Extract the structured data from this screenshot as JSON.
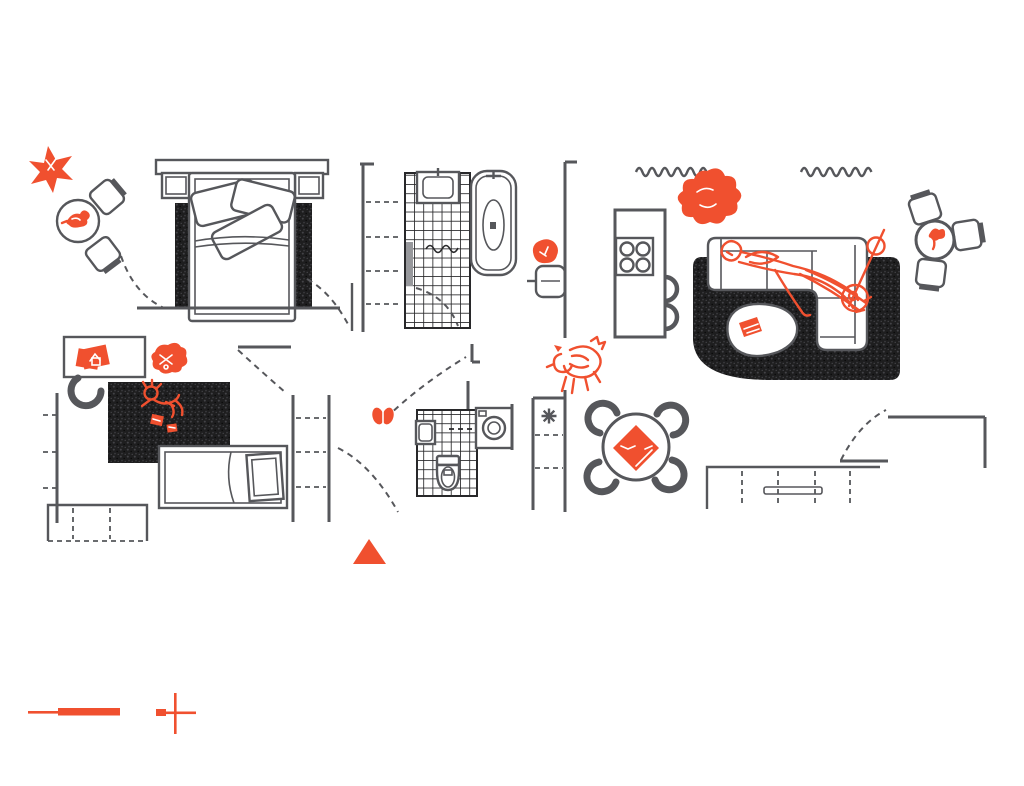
{
  "meta": {
    "kind": "hand-drawn apartment floor plan, top view, no text labels",
    "canvas": "1024x786"
  },
  "colors": {
    "paper": "#ffffff",
    "ink": "#56575b",
    "ink_dark": "#28282a",
    "accent": "#f0502f",
    "rug_dark": "#1e1e1f",
    "glass": "#97989c"
  },
  "rooms": [
    {
      "name": "balcony-left",
      "items": [
        "star-plant",
        "round-table",
        "bird",
        "chair",
        "chair"
      ]
    },
    {
      "name": "bedroom-primary",
      "items": [
        "headboard-shelf",
        "nightstand-left",
        "nightstand-right",
        "double-bed",
        "pillows-x3",
        "area-rug",
        "closet-shelves",
        "door-arcs"
      ]
    },
    {
      "name": "bathroom-main",
      "items": [
        "tiled-floor",
        "vanity-sink",
        "shower-screen",
        "shower-squiggle",
        "bathtub",
        "towel",
        "wall-cabinet"
      ]
    },
    {
      "name": "kitchen",
      "items": [
        "island-counter",
        "cooktop-4-burners",
        "bar-stool",
        "bar-stool",
        "curtain-wave-left",
        "curtain-wave-right",
        "potted-plant"
      ]
    },
    {
      "name": "living-room",
      "items": [
        "area-rug",
        "l-shaped-sofa",
        "reclining-person",
        "coffee-table",
        "book",
        "guitar"
      ]
    },
    {
      "name": "balcony-right",
      "items": [
        "round-table",
        "sprout-plant",
        "chair",
        "chair",
        "chair"
      ]
    },
    {
      "name": "dining-area",
      "items": [
        "round-table",
        "diamond-tablecloth",
        "chair-crescent-x4",
        "dog"
      ]
    },
    {
      "name": "bathroom-second",
      "items": [
        "tiled-floor",
        "hand-basin",
        "toilet",
        "washing-machine",
        "utility-closet-asterisk"
      ]
    },
    {
      "name": "bedroom-kids",
      "items": [
        "desk",
        "desk-chair",
        "orange-papers",
        "toy-scribble",
        "area-rug",
        "child-figure",
        "toy-blocks",
        "single-bed",
        "dresser",
        "closet-shelves"
      ]
    },
    {
      "name": "hallway",
      "items": [
        "door-arcs",
        "butterfly",
        "entrance-triangle"
      ]
    },
    {
      "name": "terrace-right",
      "items": [
        "sideboard-counter",
        "door-arc"
      ]
    }
  ],
  "marks": {
    "entrance_marker": "orange triangle pointing up",
    "scale_bar": "orange line and thick bar",
    "crosshair": "orange plus mark",
    "butterfly": "orange butterfly in hallway"
  },
  "counts": {
    "burners": 4,
    "dining_chairs": 4,
    "balcony_left_chairs": 2,
    "balcony_right_chairs": 3,
    "bar_stools": 2
  }
}
